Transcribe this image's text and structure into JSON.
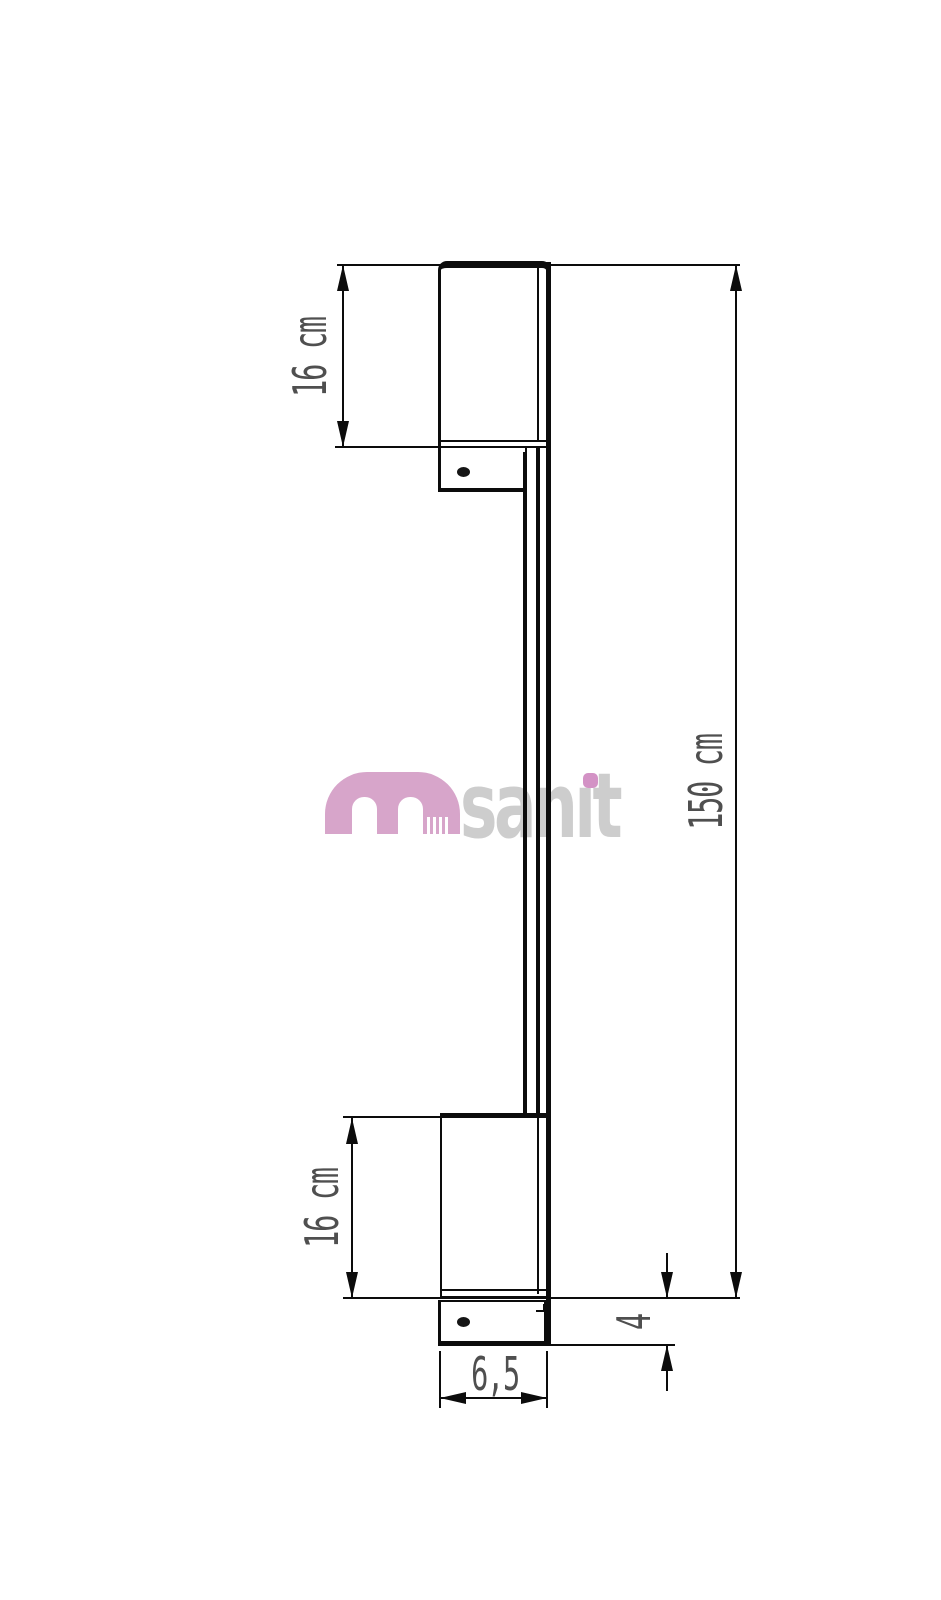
{
  "page": {
    "background": "#ffffff",
    "line_color": "#0c0c0c",
    "dim_text_color": "#4f4f4f"
  },
  "drawing": {
    "type": "technical-dimension-drawing",
    "subject": "wall-mounted bar side profile with top and bottom mounting brackets",
    "dimensions": {
      "top_section": {
        "label": "16 cm",
        "orientation": "vertical"
      },
      "bottom_section": {
        "label": "16 cm",
        "orientation": "vertical"
      },
      "total_height": {
        "label": "150 cm",
        "orientation": "vertical"
      },
      "bracket_width": {
        "label": "6,5",
        "orientation": "horizontal"
      },
      "plate_height": {
        "label": "4",
        "orientation": "vertical"
      }
    }
  },
  "watermark": {
    "text": "msanit",
    "logo_letter": "m",
    "name_pre": "san",
    "name_i_dotless": "ı",
    "name_post": "t",
    "logo_color": "#d7a5ca",
    "name_color": "#cdcdcd",
    "i_dot_color": "#d392c5"
  }
}
